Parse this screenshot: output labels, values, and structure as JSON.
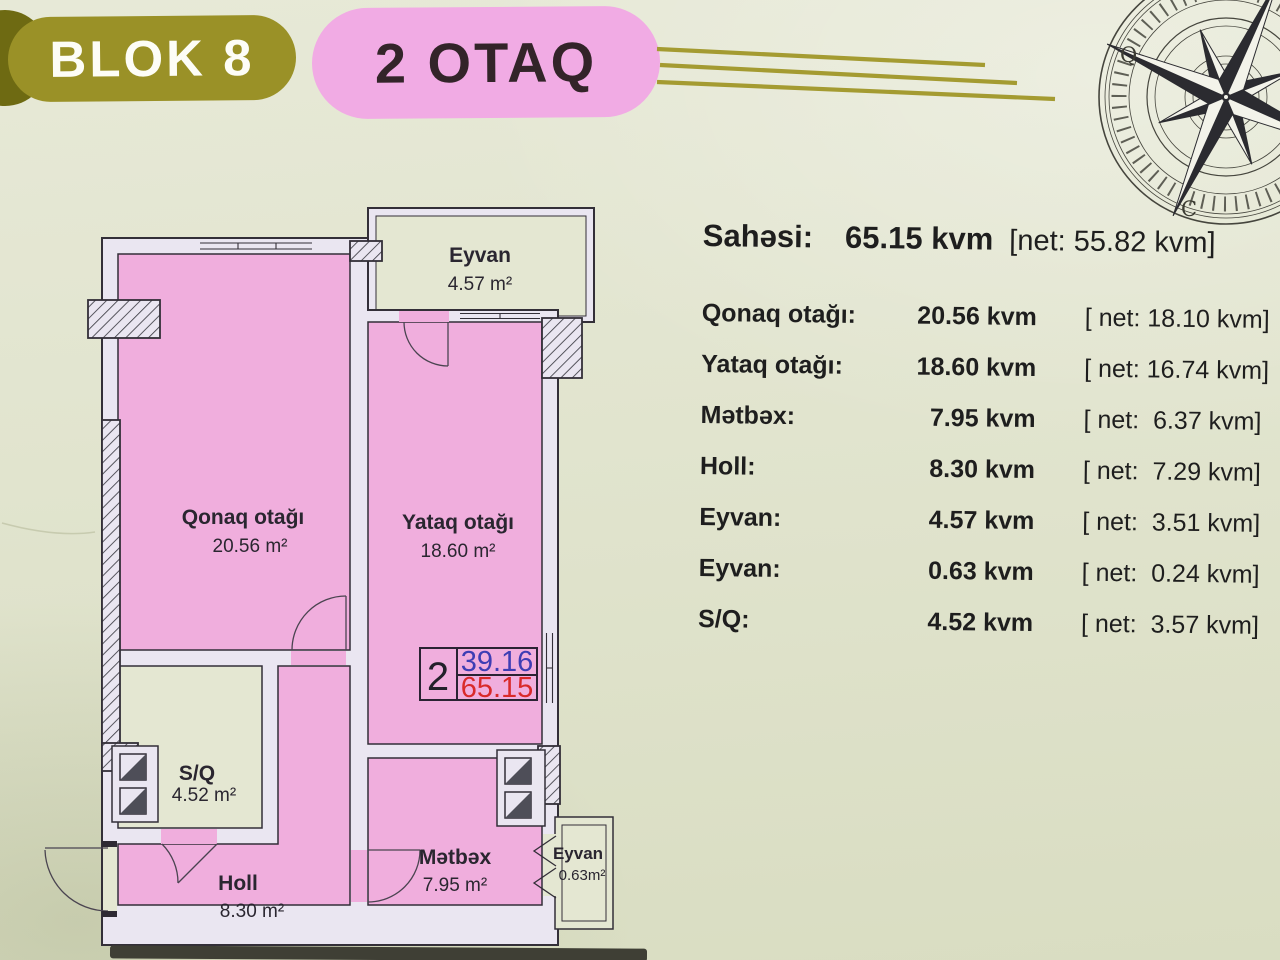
{
  "header": {
    "block": "BLOK 8",
    "rooms": "2 OTAQ"
  },
  "compass": {
    "west": "Q",
    "south": "C"
  },
  "plan": {
    "rooms": [
      {
        "name": "Eyvan",
        "area": "4.57 m²"
      },
      {
        "name": "Qonaq otağı",
        "area": "20.56 m²"
      },
      {
        "name": "Yataq otağı",
        "area": "18.60 m²"
      },
      {
        "name": "S/Q",
        "area": "4.52 m²"
      },
      {
        "name": "Holl",
        "area": "8.30 m²"
      },
      {
        "name": "Mətbəx",
        "area": "7.95 m²"
      },
      {
        "name": "Eyvan",
        "area": "0.63m²"
      }
    ],
    "unit_box": {
      "rooms": "2",
      "net": "39.16",
      "gross": "65.15"
    }
  },
  "summary": {
    "title": {
      "label": "Sahəsi:",
      "value": "65.15 kvm",
      "net": "[net: 55.82 kvm]"
    },
    "rows": [
      {
        "label": "Qonaq otağı:",
        "value": "20.56 kvm",
        "net": "[ net: 18.10 kvm]"
      },
      {
        "label": "Yataq otağı:",
        "value": "18.60 kvm",
        "net": "[ net: 16.74 kvm]"
      },
      {
        "label": "Mətbəx:",
        "value": "7.95 kvm",
        "net": "[ net:  6.37 kvm]"
      },
      {
        "label": "Holl:",
        "value": "8.30 kvm",
        "net": "[ net:  7.29 kvm]"
      },
      {
        "label": "Eyvan:",
        "value": "4.57 kvm",
        "net": "[ net:  3.51 kvm]"
      },
      {
        "label": "Eyvan:",
        "value": "0.63  kvm",
        "net": "[ net:  0.24 kvm]"
      },
      {
        "label": "S/Q:",
        "value": "4.52 kvm",
        "net": "[ net:  3.57 kvm]"
      }
    ]
  },
  "colors": {
    "background": "#e1e4ce",
    "room_fill": "#f0aedd",
    "wall_fill": "#eae6f1",
    "outline": "#332f38",
    "balcony_fill": "#e4e7d2",
    "block_pill": "#9a9127",
    "rooms_pill": "#f1abe4",
    "gold_line": "#a49b31",
    "net_area_blue": "#3d3db4",
    "gross_area_red": "#d92a2a"
  }
}
